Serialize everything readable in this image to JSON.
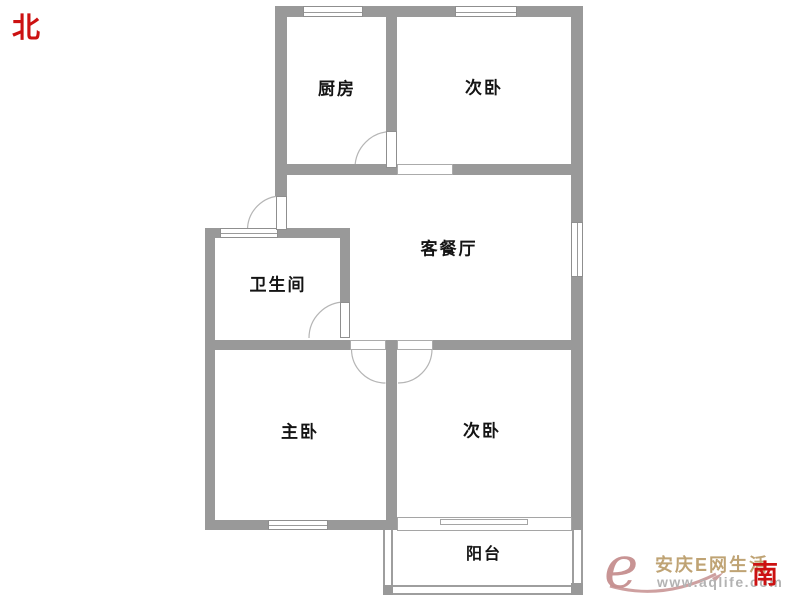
{
  "compass": {
    "north_label": "北",
    "south_label": "南"
  },
  "rooms": [
    {
      "id": "kitchen",
      "label": "厨房"
    },
    {
      "id": "bedroom-north",
      "label": "次卧"
    },
    {
      "id": "living-dining",
      "label": "客餐厅"
    },
    {
      "id": "bathroom",
      "label": "卫生间"
    },
    {
      "id": "master-bedroom",
      "label": "主卧"
    },
    {
      "id": "bedroom-south",
      "label": "次卧"
    },
    {
      "id": "balcony",
      "label": "阳台"
    }
  ],
  "watermark": {
    "logo_letter": "e",
    "brand": "安庆E网生活",
    "url": "www.aqlife.com"
  },
  "colors": {
    "wall": "#999999",
    "door_arc": "#b5b5b5",
    "label_text": "#141414",
    "compass_red": "#cc1111",
    "logo_pink": "#c68f8f",
    "brand_tan": "#b99a66",
    "url_gray": "#b3b3b3",
    "background": "#ffffff"
  }
}
